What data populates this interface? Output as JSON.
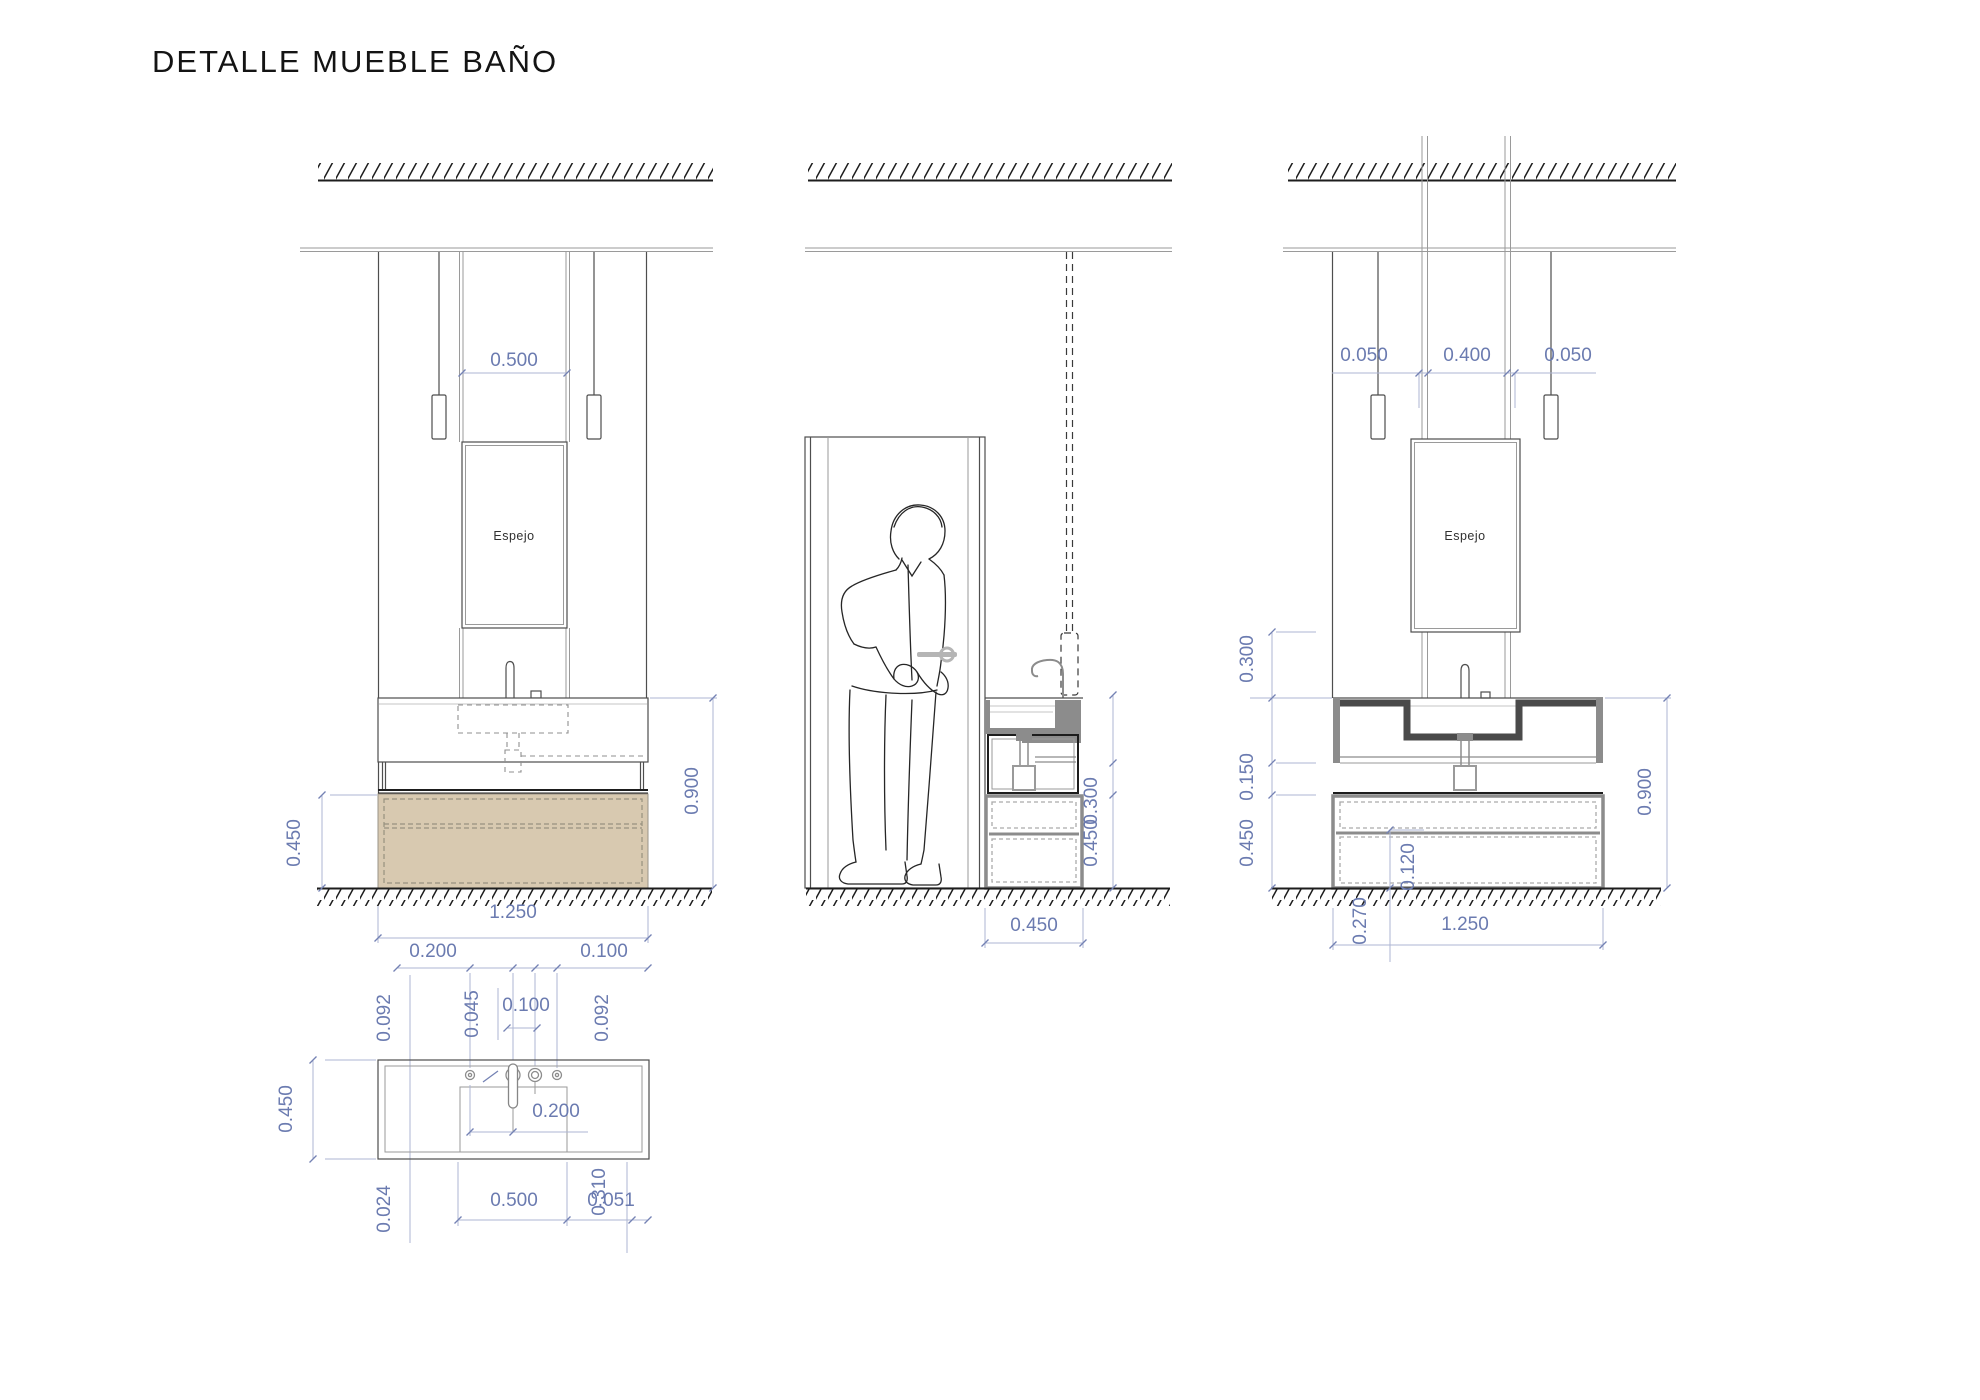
{
  "title": "DETALLE MUEBLE BAÑO",
  "colors": {
    "dimension_text": "#6b7bb0",
    "dimension_line": "#adb6d3",
    "cabinet_fill": "#d8c9b0",
    "section_gray": "#8c8c8c",
    "line_dark": "#4e4e4e"
  },
  "views": {
    "left_elevation": {
      "mirror_label": "Espejo",
      "dims": {
        "mirror_width": "0.500",
        "cabinet_height": "0.450",
        "counter_height": "0.900",
        "total_width": "1.250",
        "chain_left": "0.200",
        "chain_right": "0.100"
      }
    },
    "middle_section": {
      "dims": {
        "counter_zone": "0.300",
        "cabinet_height": "0.450",
        "depth": "0.450"
      }
    },
    "right_elevation": {
      "mirror_label": "Espejo",
      "dims": {
        "gap_left": "0.050",
        "mirror_rods": "0.400",
        "gap_right": "0.050",
        "mirror_to_counter": "0.300",
        "frame_height": "0.150",
        "cabinet_height": "0.450",
        "counter_height": "0.900",
        "drawer_height": "0.120",
        "drawer_base": "0.270",
        "total_width": "1.250"
      }
    },
    "plan": {
      "dims": {
        "hole_left": "0.092",
        "hole_gap": "0.045",
        "holes_span": "0.100",
        "hole_right": "0.092",
        "depth": "0.450",
        "faucet_offset": "0.200",
        "rim": "0.024",
        "basin_width": "0.500",
        "basin_depth": "0.310",
        "basin_edge": "0.051"
      }
    }
  }
}
